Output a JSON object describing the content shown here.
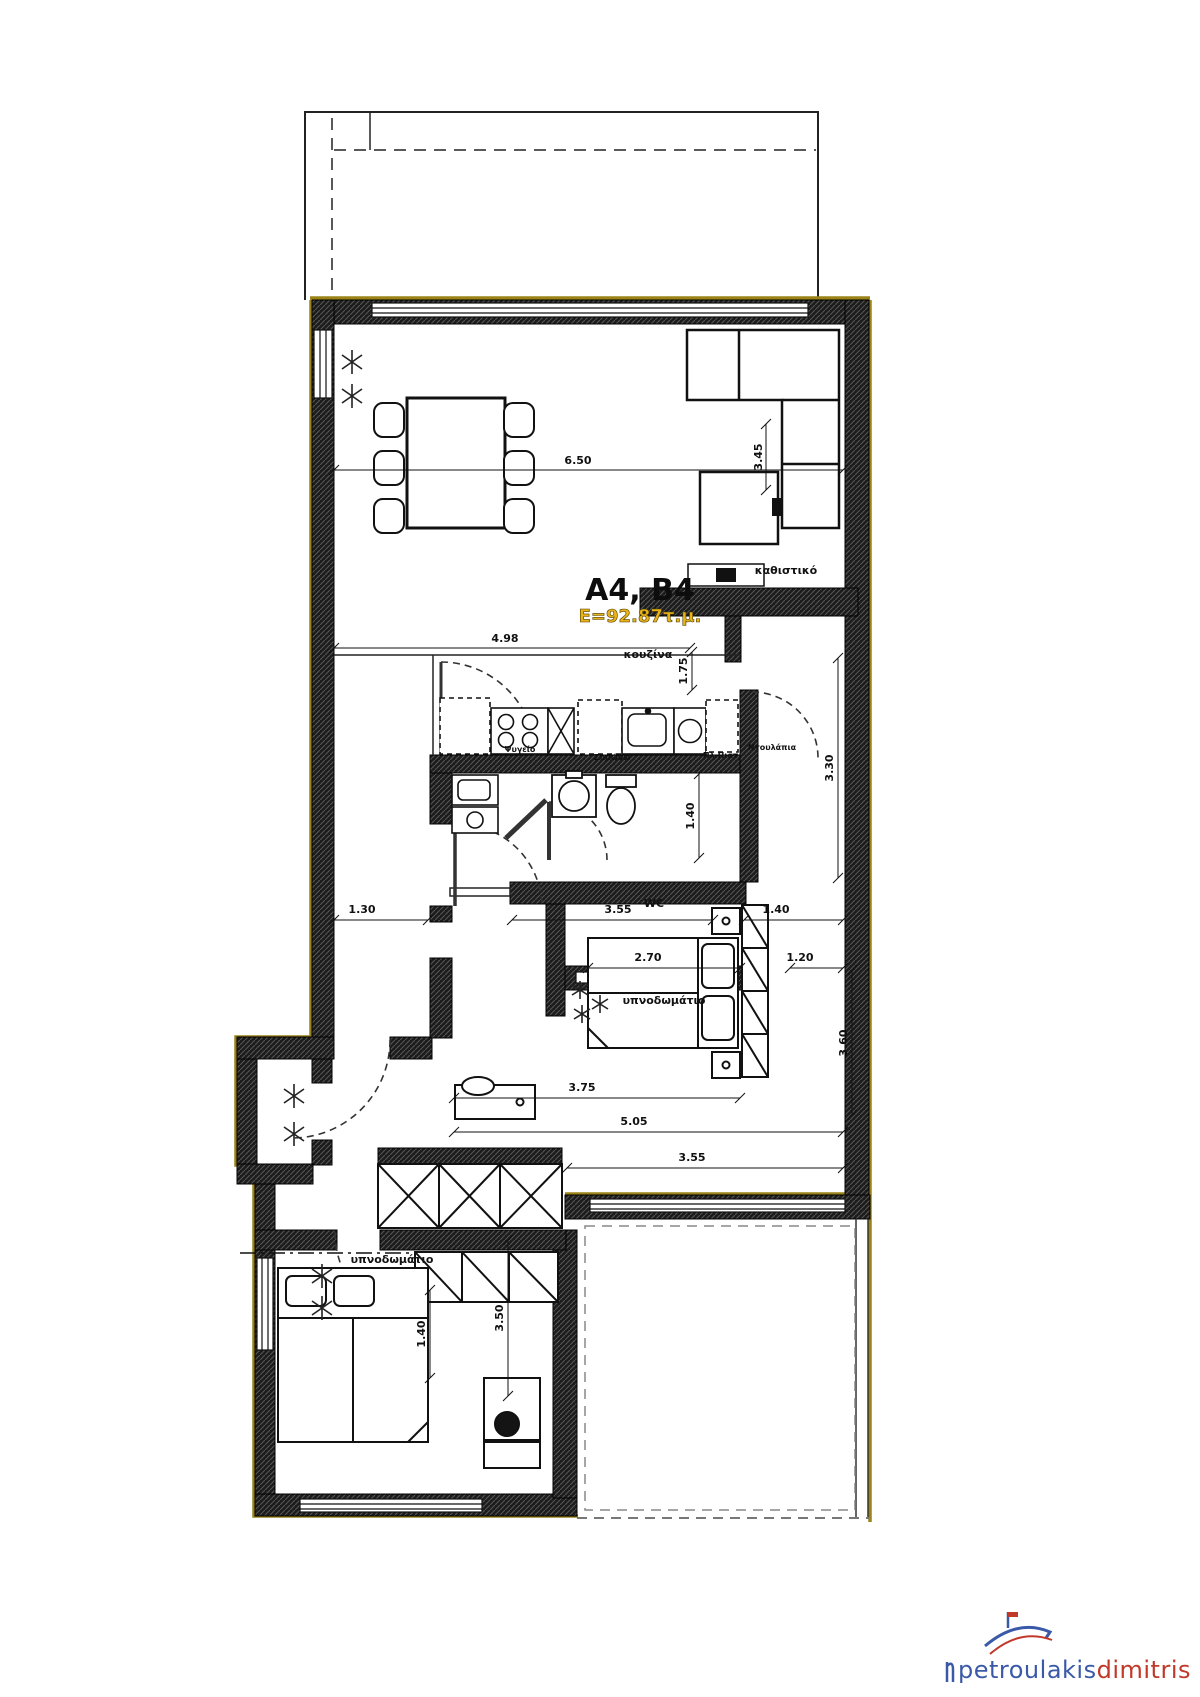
{
  "plan": {
    "unit_title": "A4, B4",
    "area": "E=92.87τ.μ.",
    "rooms": {
      "living": "καθιστικό",
      "kitchen": "κουζίνα",
      "wc": "WC",
      "bedroom_right": "υπνοδωμάτιο",
      "bedroom_lower": "υπνοδωμάτιο"
    },
    "fixtures": {
      "fridge": "Ψυγείο",
      "prep": "Ζυμώνω",
      "dishwasher": "Πλ.Πιατ.",
      "cupboards": "Ντουλάπια"
    },
    "dimensions": {
      "living_width": "6.50",
      "living_depth": "3.45",
      "kitchen_width": "4.98",
      "kitchen_depth": "1.75",
      "hall_depth": "3.30",
      "row_left": "1.30",
      "row_mid": "3.55",
      "row_right": "1.40",
      "wc_depth": "1.40",
      "bed1_width": "2.70",
      "bed1_side": "1.20",
      "bed1_depth": "3.60",
      "bed1_total": "3.75",
      "lower_total": "5.05",
      "terrace_width": "3.55",
      "bed2_depth": "3.50",
      "bed2_bed": "1.40"
    }
  },
  "logo": {
    "brand_blue": "petroulakis",
    "brand_red": "dimitris"
  },
  "colors": {
    "accent_yellow": "#E9B219",
    "wall_trim": "#9a8418",
    "logo_blue": "#3a5aa8",
    "logo_red": "#c0392b"
  }
}
